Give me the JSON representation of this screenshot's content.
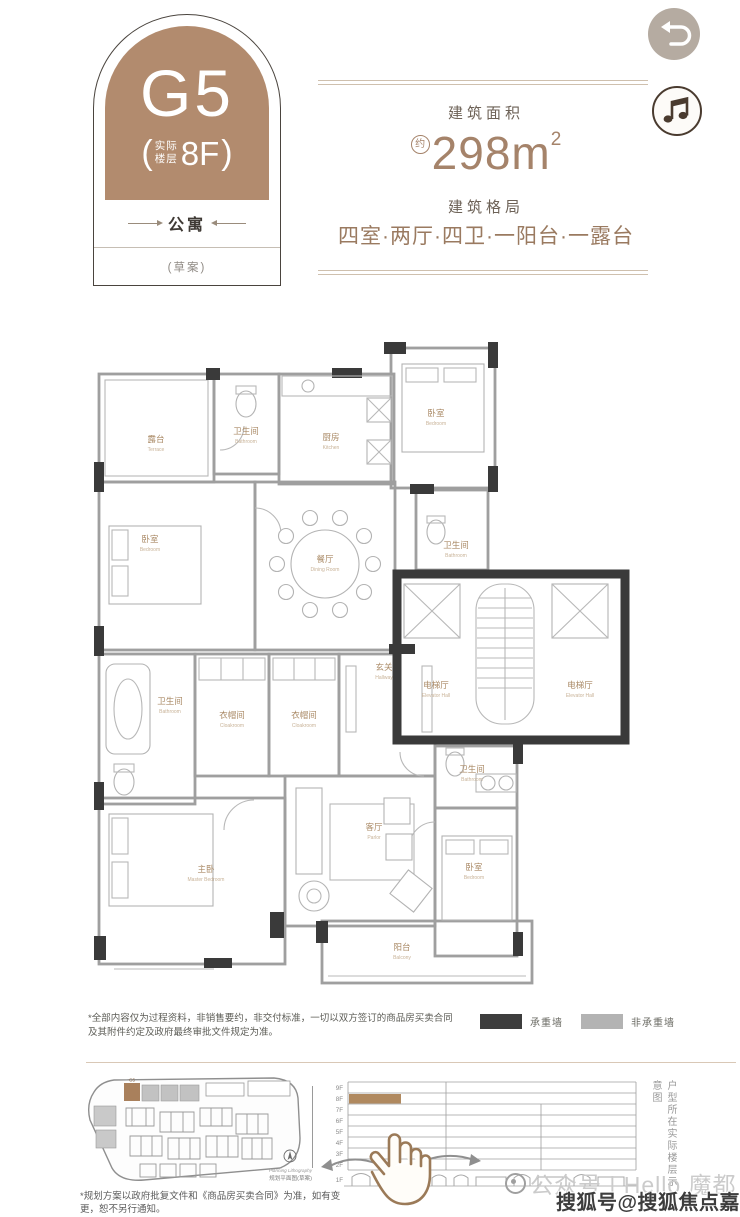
{
  "badge": {
    "unit": "G5",
    "bracket_open": "(",
    "bracket_close": ")",
    "floor_note_1": "实际",
    "floor_note_2": "楼层",
    "floor_value": "8F",
    "type": "公寓",
    "draft": "(草案)"
  },
  "header": {
    "area_label": "建筑面积",
    "area_approx": "约",
    "area_value": "298m",
    "area_sup": "2",
    "layout_label": "建筑格局",
    "layout_value": "四室·两厅·四卫·一阳台·一露台"
  },
  "floorplan": {
    "rooms": [
      {
        "cn": "露台",
        "en": "Terrace"
      },
      {
        "cn": "卫生间",
        "en": "Bathroom"
      },
      {
        "cn": "厨房",
        "en": "Kitchen"
      },
      {
        "cn": "卧室",
        "en": "Bedroom"
      },
      {
        "cn": "餐厅",
        "en": "Dining Room"
      },
      {
        "cn": "卧室",
        "en": "Bedroom"
      },
      {
        "cn": "卫生间",
        "en": "Bathroom"
      },
      {
        "cn": "电梯厅",
        "en": "Elevator Hall"
      },
      {
        "cn": "电梯厅",
        "en": "Elevator Hall"
      },
      {
        "cn": "卫生间",
        "en": "Bathroom"
      },
      {
        "cn": "衣帽间",
        "en": "Cloakroom"
      },
      {
        "cn": "衣帽间",
        "en": "Cloakroom"
      },
      {
        "cn": "玄关",
        "en": "Hallway"
      },
      {
        "cn": "主卧",
        "en": "Master Bedroom"
      },
      {
        "cn": "客厅",
        "en": "Parlor"
      },
      {
        "cn": "卫生间",
        "en": "Bathroom"
      },
      {
        "cn": "卧室",
        "en": "Bedroom"
      },
      {
        "cn": "阳台",
        "en": "Balcony"
      }
    ]
  },
  "legend": {
    "load_bearing": "承重墙",
    "non_load_bearing": "非承重墙",
    "load_color": "#3d3d3d",
    "non_load_color": "#b3b3b3"
  },
  "disclaimer": "*全部内容仅为过程资料，非销售要约，非交付标准，一切以双方签订的商品房买卖合同及其附件约定及政府最终审批文件规定为准。",
  "site_map": {
    "highlight_unit": "G5",
    "highlight_color": "#a9805c",
    "compass_label_en": "Planning Lithography",
    "caption": "规划平面图(草案)",
    "footnote": "*规划方案以政府批复文件和《商品房买卖合同》为准，如有变更，恕不另行通知。"
  },
  "floor_chart": {
    "floors": [
      "9F",
      "8F",
      "7F",
      "6F",
      "5F",
      "4F",
      "3F",
      "2F",
      "1F"
    ],
    "highlight_floor": "8F",
    "highlight_color": "#b0895f",
    "caption_vertical": "户型所在实际楼层示意图"
  },
  "watermarks": {
    "wechat": "公众号 | Hello 魔都",
    "sohu": "搜狐号@搜狐焦点嘉定站"
  }
}
